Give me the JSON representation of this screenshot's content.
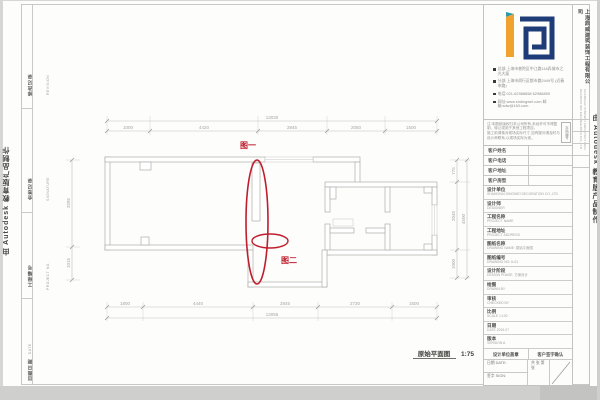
{
  "watermark": {
    "text": "由 Autodesk 教育版产品制作"
  },
  "logo": {
    "company_cn": "上海鼎威建筑装饰工程有限公司",
    "company_en": "SHANGHAI DINGWEI ARCHITECTURAL DECORATION ENGINEERING CO.,LTD",
    "orange": "#f0a22e",
    "navy": "#1e3c78",
    "teal": "#2e9aa6"
  },
  "contact_items": [
    "总部:上海市普陀区中江路118弄城市之光大厦",
    "分部:上海市闵行区都市路2449号 (近春申路)",
    "电话:021-62988858  62988859",
    "网址:www.shdingwei.com  邮箱:sdw@163.com"
  ],
  "notice": {
    "para1": "注:本图纸版权归本公司所有,未经许可不得复制、转让或用于其他工程项目。",
    "para2": "施工前请核对现场实际尺寸,如有疑问请及时与设计师联系,以现场实际为准。",
    "tag": "存档编号"
  },
  "customer_rows": [
    {
      "label": "客户姓名"
    },
    {
      "label": "客户电话"
    },
    {
      "label": "客户地址"
    },
    {
      "label": "客户房型"
    }
  ],
  "info_rows": [
    {
      "label": "设计单位",
      "sub": "SHANGHAI DINGWEI DECORATION CO.,LTD"
    },
    {
      "label": "设计师",
      "sub": "DESIGNER"
    },
    {
      "label": "工程名称",
      "sub": "PROJECT NAME"
    },
    {
      "label": "工程地址",
      "sub": "PROJECT ADDRESS"
    },
    {
      "label": "图纸名称",
      "sub": "DRAWING NAME: 原始平面图"
    },
    {
      "label": "图纸编号",
      "sub": "DRAWING NO: A-01"
    },
    {
      "label": "设计阶段",
      "sub": "DESIGN PHASE: 方案设计"
    },
    {
      "label": "绘图",
      "sub": "DRAWN BY"
    },
    {
      "label": "审核",
      "sub": "CHECKED BY"
    },
    {
      "label": "比例",
      "sub": "SCALE 1:100"
    },
    {
      "label": "日期",
      "sub": "DATE 2015.07"
    },
    {
      "label": "版本",
      "sub": "VERSION A"
    }
  ],
  "stamp": {
    "left_header": "设计单位盖章",
    "right_header": "客户签字确认",
    "date_label": "日期 DATE:",
    "sign_label": "签字 SIGN:",
    "pages_label": "共 张 第 张"
  },
  "side_cells": [
    {
      "label": "修改记录",
      "sub": "REVISION"
    },
    {
      "label": "会签记录",
      "sub": "SIGNATURE"
    },
    {
      "label": "工程编号",
      "sub": "PROJECT NO."
    },
    {
      "label": "出图日期",
      "sub": "DATE"
    }
  ],
  "plan": {
    "title": "原始平面图",
    "scale": "1:75",
    "fig1": "图一",
    "fig2": "图二",
    "dims_top_total": "13030",
    "dims_top": [
      "1000",
      "4420",
      "2845",
      "2050",
      "1500"
    ],
    "dims_bottom": [
      "1800",
      "4440",
      "2845",
      "2730",
      "1500"
    ],
    "dims_bottom_total": "13055",
    "dims_left": [
      "3285",
      "1015"
    ],
    "dims_right": [
      "775",
      "2045",
      "1000"
    ],
    "dims_right_total": "4500",
    "red": "#bf1e2e"
  }
}
